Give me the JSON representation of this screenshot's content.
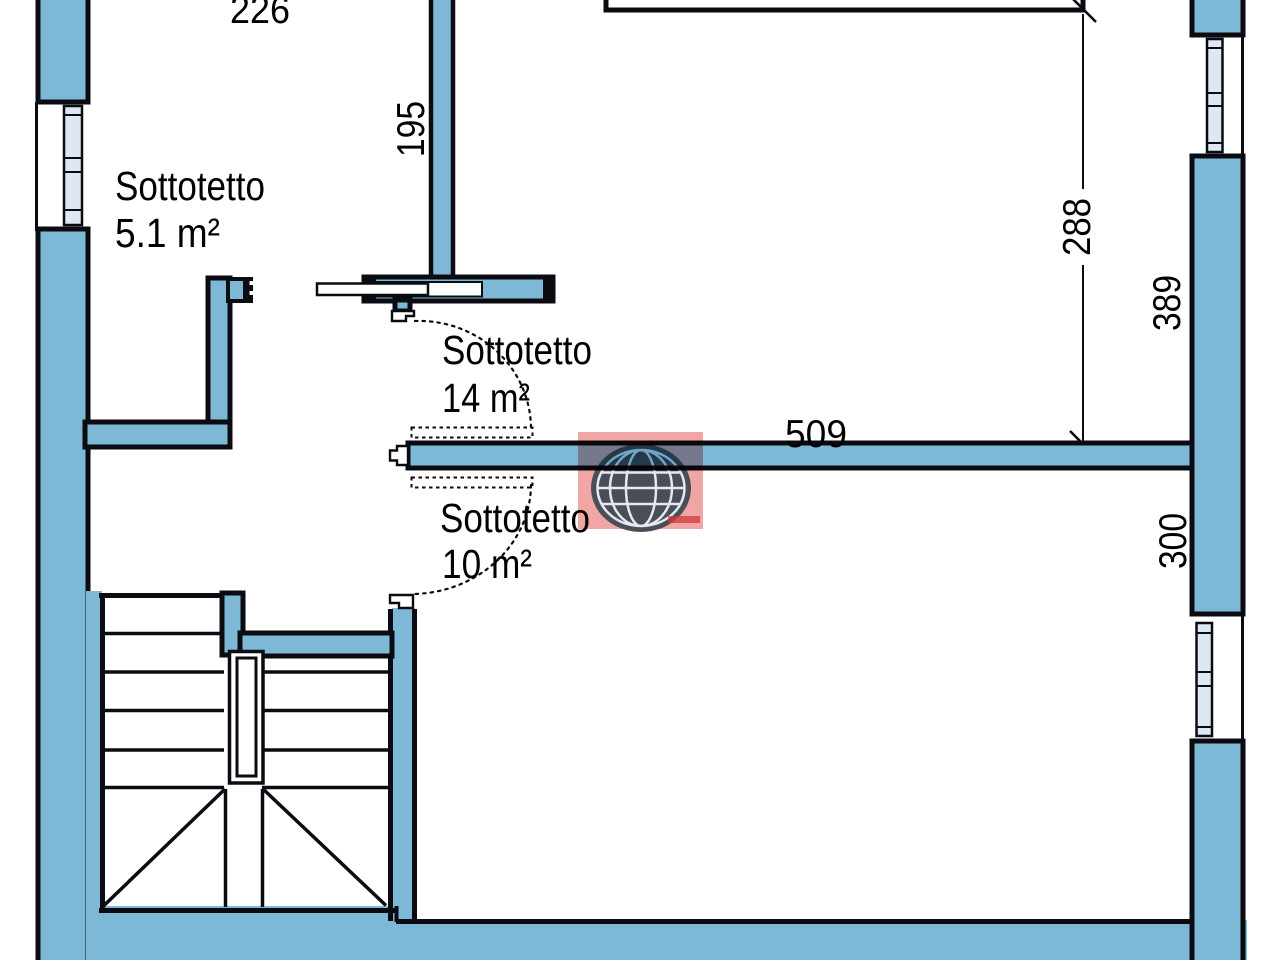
{
  "colors": {
    "wall_fill": "#7db8d6",
    "glass_fill": "#dde8f2",
    "line": "#0b0b12",
    "paper": "#ffffff",
    "logo_red": "#f09c9c",
    "logo_globe": "#4b4e57",
    "logo_text_red": "#d23b3b"
  },
  "rooms": [
    {
      "name": "Sottotetto",
      "area": "5.1 m²"
    },
    {
      "name": "Sottotetto",
      "area": "14 m²"
    },
    {
      "name": "Sottotetto",
      "area": "10 m²"
    }
  ],
  "dimensions": {
    "top_width": "226",
    "entry_wall": "195",
    "upper_room_height": "288",
    "right_wall_upper": "389",
    "central_wall_width": "509",
    "lower_room_height": "300"
  },
  "watermark": {
    "icon": "globe-icon"
  }
}
